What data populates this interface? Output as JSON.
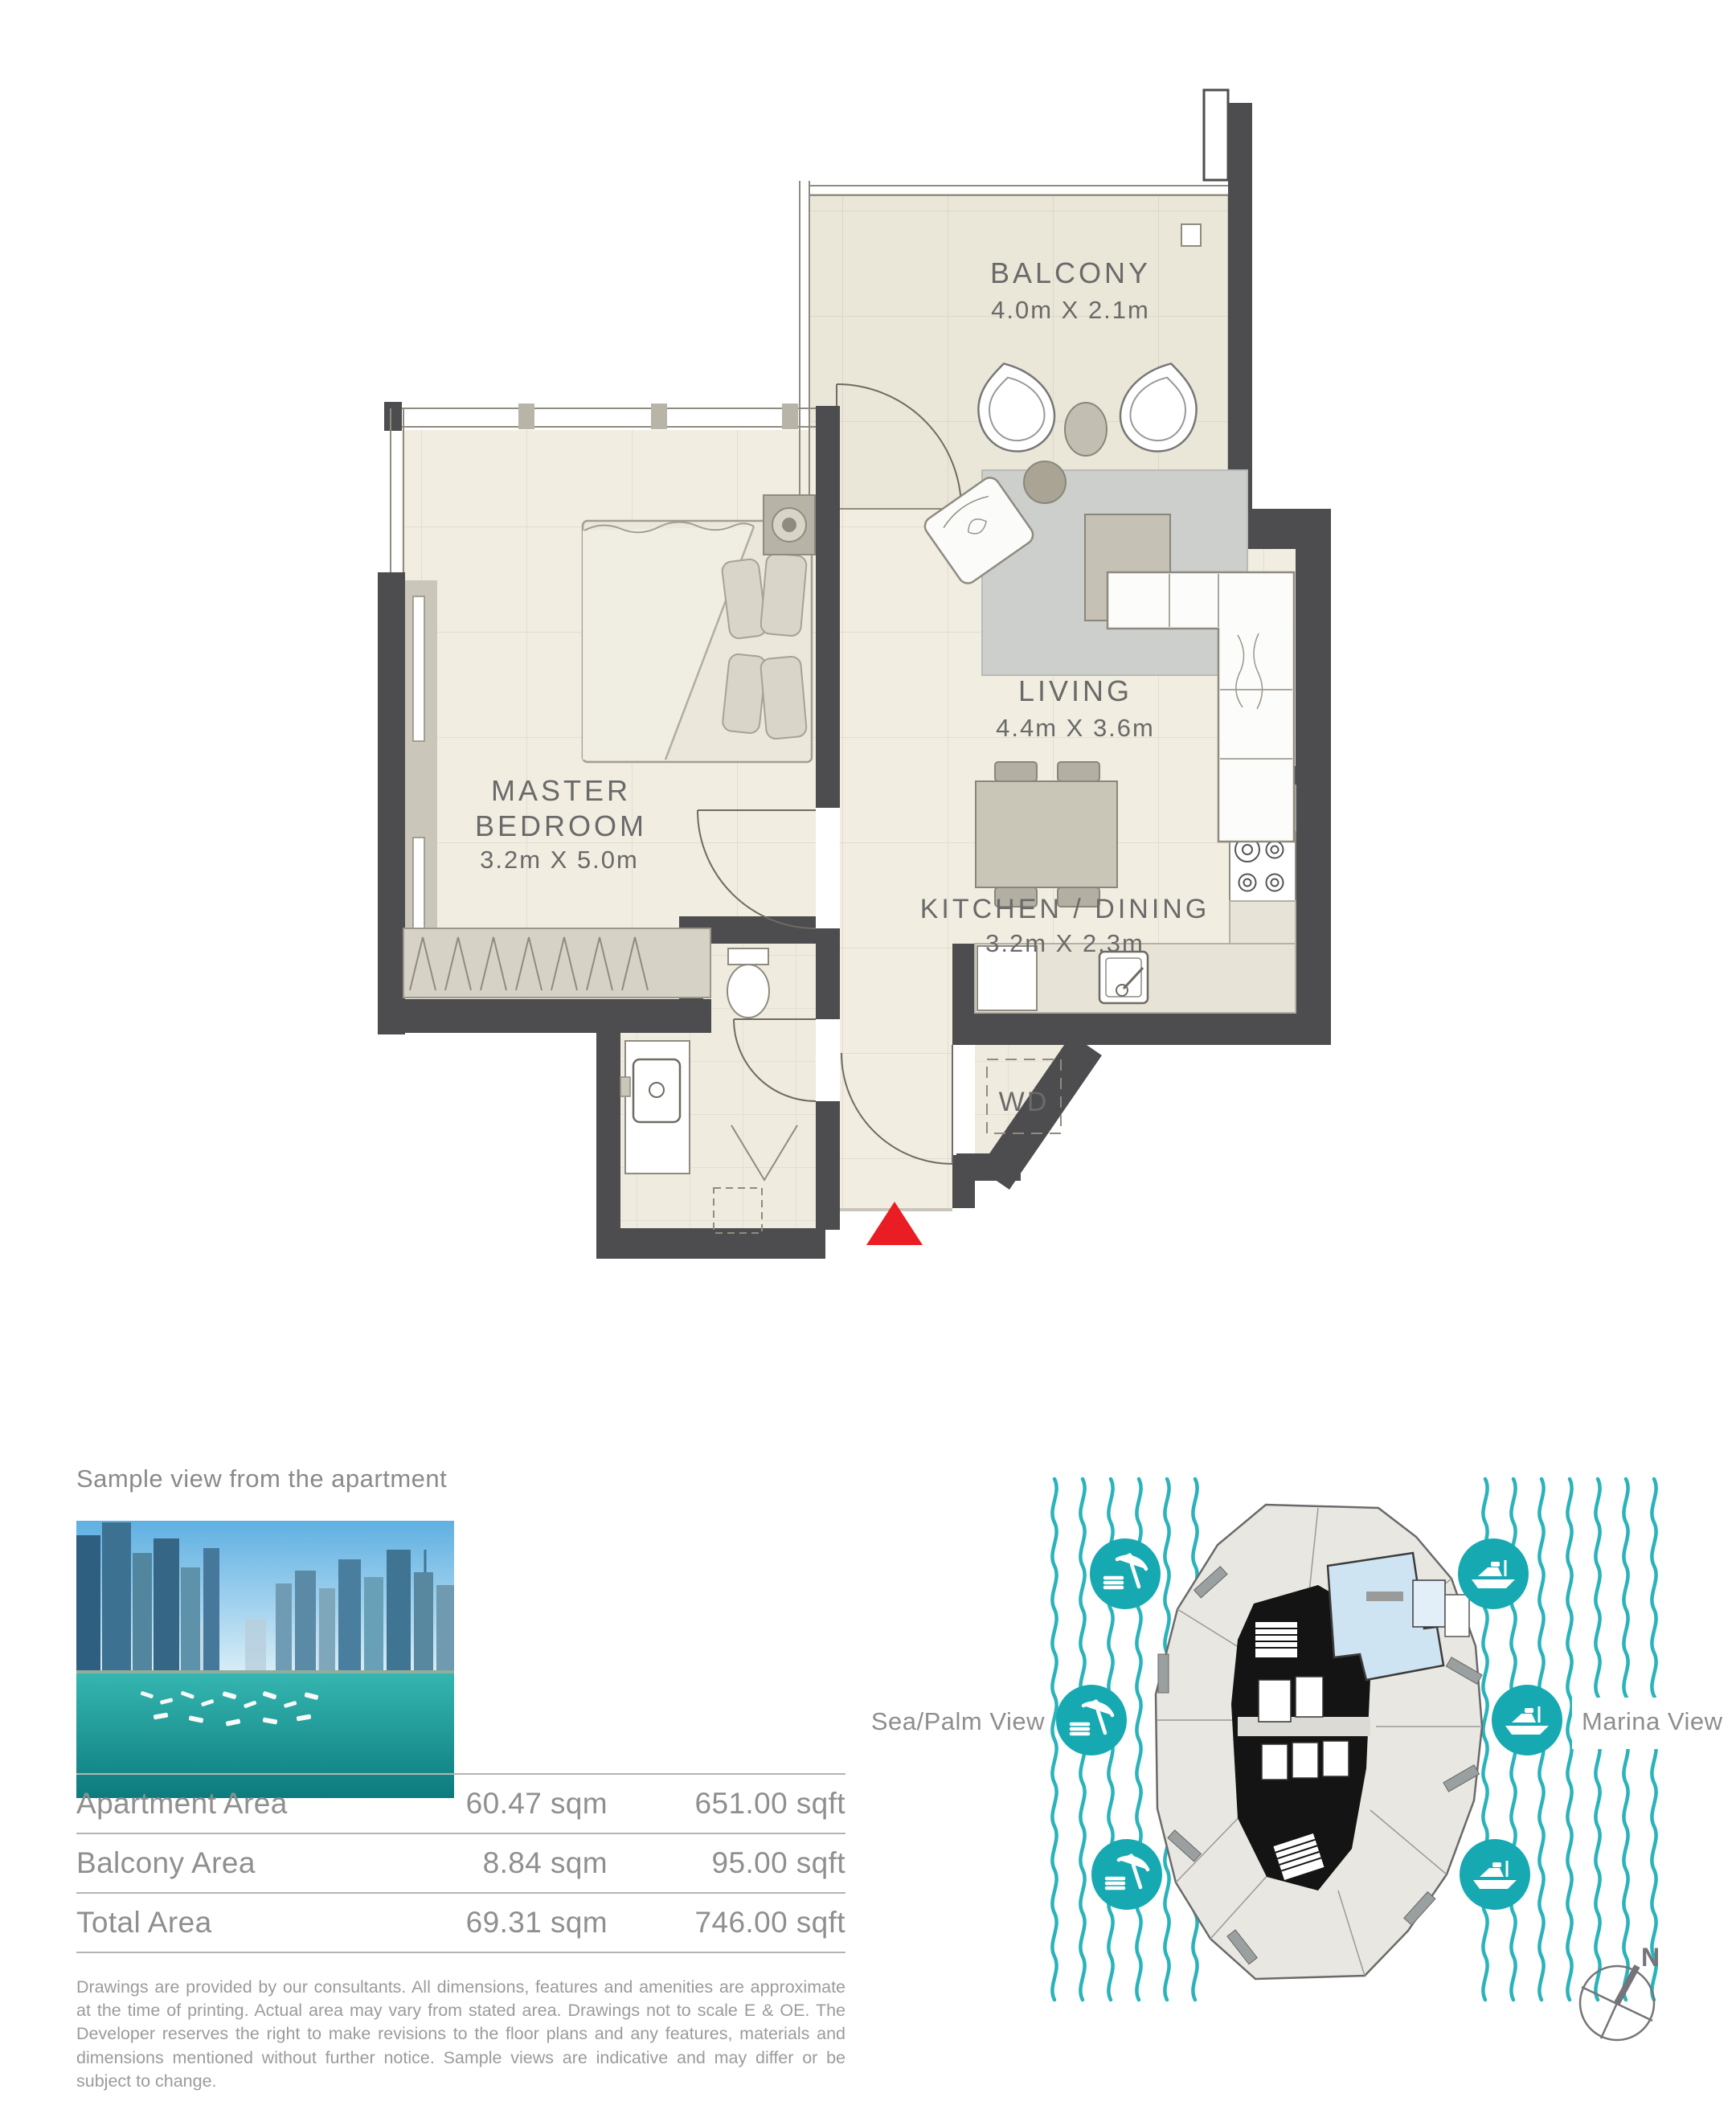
{
  "floor_plan": {
    "balcony": {
      "name": "BALCONY",
      "dims": "4.0m X 2.1m"
    },
    "living": {
      "name": "LIVING",
      "dims": "4.4m X 3.6m"
    },
    "master_bedroom": {
      "name_line1": "MASTER",
      "name_line2": "BEDROOM",
      "dims": "3.2m X 5.0m"
    },
    "kitchen_dining": {
      "name": "KITCHEN / DINING",
      "dims": "3.2m X 2.3m"
    },
    "laundry": {
      "label": "WD"
    }
  },
  "sample_view": {
    "caption": "Sample view from the apartment"
  },
  "area_table": {
    "rows": [
      {
        "label": "Apartment Area",
        "sqm": "60.47 sqm",
        "sqft": "651.00 sqft"
      },
      {
        "label": "Balcony Area",
        "sqm": "8.84 sqm",
        "sqft": "95.00 sqft"
      },
      {
        "label": "Total Area",
        "sqm": "69.31 sqm",
        "sqft": "746.00 sqft"
      }
    ]
  },
  "disclaimer": "Drawings are provided by our consultants. All dimensions, features and amenities are approximate at the time of printing. Actual area may vary from stated area.  Drawings not to scale E & OE.  The Developer reserves the right to make revisions to the floor plans and any features, materials and dimensions mentioned without further notice.  Sample views are indicative and may differ or be subject to change.",
  "key_plan": {
    "left_label": "Sea/Palm View",
    "right_label": "Marina View",
    "compass_north": "N"
  },
  "colors": {
    "wall": "#4d4d4f",
    "teal_wave": "#2ab3ba",
    "view_icon_teal": "#17a9b2",
    "entry_marker_red": "#ea1c24",
    "unit_highlight_blue": "#cfe4f3",
    "floor_beige": "#f1ede1",
    "text_gray": "#8f8f8f"
  }
}
